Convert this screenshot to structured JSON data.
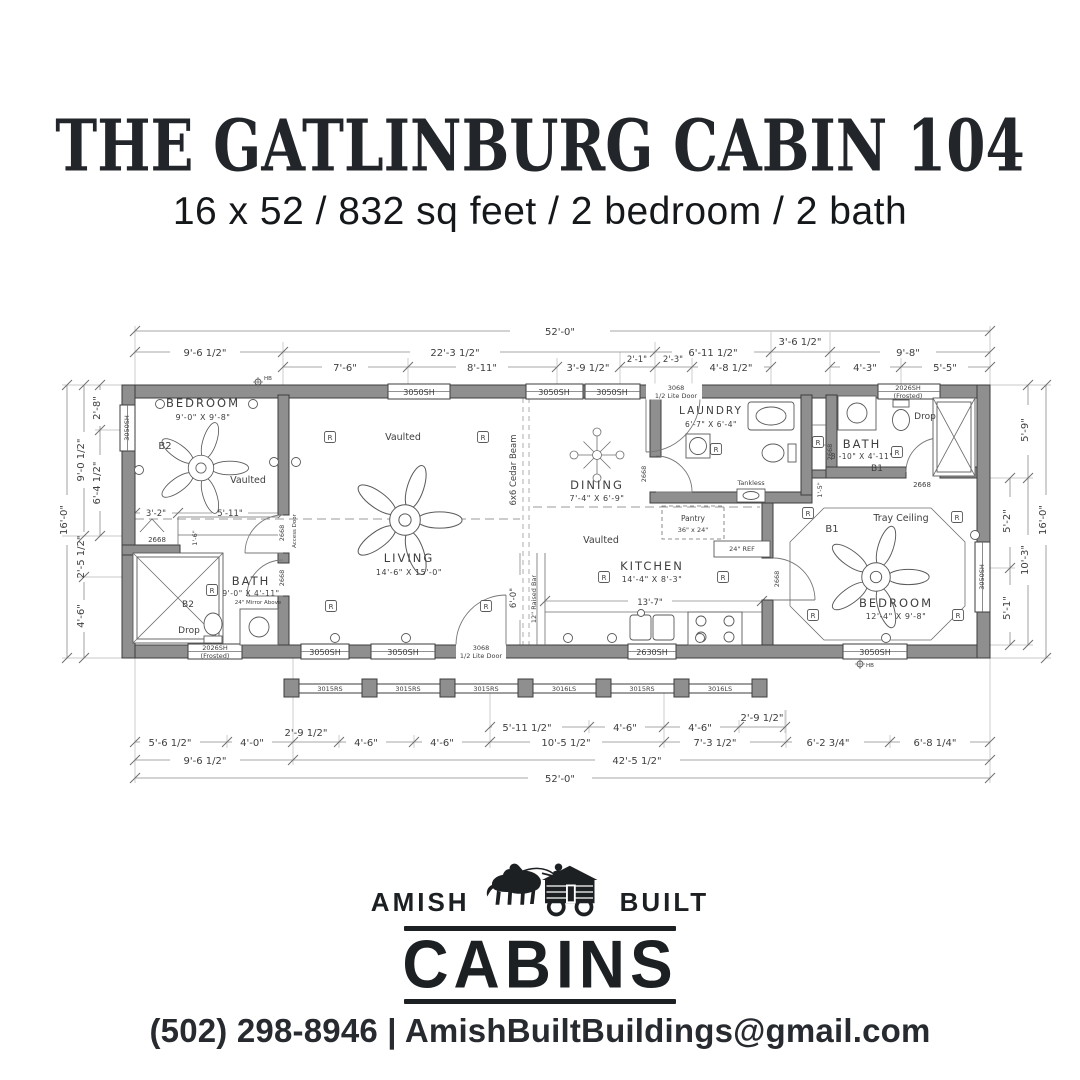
{
  "header": {
    "title": "THE GATLINBURG CABIN 104",
    "subtitle": "16 x 52 / 832 sq feet / 2 bedroom / 2 bath"
  },
  "logo": {
    "amish": "AMISH",
    "built": "BUILT",
    "cabins": "CABINS"
  },
  "footer": {
    "contact": "(502) 298-8946 | AmishBuiltBuildings@gmail.com"
  },
  "plan": {
    "rooms": {
      "bedroom2": {
        "name": "BEDROOM",
        "size": "9'-0\" X 9'-8\"",
        "tag": "B2",
        "ceiling": "Vaulted"
      },
      "living": {
        "name": "LIVING",
        "size": "14'-6\" X 15'-0\"",
        "ceiling": "Vaulted"
      },
      "dining": {
        "name": "DINING",
        "size": "7'-4\" X 6'-9\"",
        "ceiling": "Vaulted"
      },
      "kitchen": {
        "name": "KITCHEN",
        "size": "14'-4\" X 8'-3\""
      },
      "laundry": {
        "name": "LAUNDRY",
        "size": "6'-7\" X 6'-4\""
      },
      "bath1": {
        "name": "BATH",
        "size": "8'-10\" X 4'-11\"",
        "tag": "B1"
      },
      "bath2": {
        "name": "BATH",
        "size": "9'-0\" X 4'-11\"",
        "tag": "B2"
      },
      "bedroom1": {
        "name": "BEDROOM",
        "size": "12'-4\" X 9'-8\"",
        "tag": "B1",
        "ceiling": "Tray Ceiling"
      }
    },
    "labels": {
      "drop": "Drop",
      "access_door": "Access Door",
      "cedar_beam": "6x6 Cedar Beam",
      "raised_bar": "12\" Raised Bar",
      "tankless": "Tankless",
      "pantry": "Pantry",
      "pantry_size": "36\" x 24\"",
      "ref": "24\" REF",
      "mirror24": "24\" Mirror Above",
      "receptacle": "R",
      "hb": "HB",
      "door": "2668"
    },
    "windows": {
      "w3050": "3050SH",
      "w2026": "2026SH",
      "frosted": "(Frosted)",
      "w2630": "2630SH",
      "door3068": "3068",
      "door3068b": "1/2 Lite Door",
      "rail_rs": "3015RS",
      "rail_ls": "3016LS"
    },
    "dims": {
      "overall_w": "52'-0\"",
      "overall_h": "16'-0\"",
      "top2": [
        "9'-6 1/2\"",
        "22'-3 1/2\"",
        "6'-11 1/2\"",
        "3'-6 1/2\"",
        "9'-8\""
      ],
      "top3": [
        "7'-6\"",
        "8'-11\"",
        "3'-9 1/2\"",
        "2'-1\"",
        "2'-3\"",
        "4'-8 1/2\"",
        "4'-3\"",
        "5'-5\""
      ],
      "left": [
        "2'-8\"",
        "9'-0 1/2\"",
        "6'-4 1/2\"",
        "2'-5 1/2\"",
        "4'-6\""
      ],
      "right": [
        "5'-9\"",
        "5'-2\"",
        "10'-3\"",
        "5'-1\""
      ],
      "bottom_a": [
        "5'-11 1/2\"",
        "4'-6\"",
        "4'-6\"",
        "2'-9 1/2\""
      ],
      "bottom_b": [
        "5'-6 1/2\"",
        "4'-0\"",
        "2'-9 1/2\"",
        "4'-6\"",
        "4'-6\"",
        "10'-5 1/2\"",
        "7'-3 1/2\"",
        "6'-2 3/4\"",
        "6'-8 1/4\""
      ],
      "bottom_c": [
        "9'-6 1/2\"",
        "42'-5 1/2\""
      ],
      "inner": [
        "3'-2\"",
        "5'-11\"",
        "1'-6\"",
        "13'-7\"",
        "6'-0\"",
        "1'-5\""
      ]
    }
  }
}
